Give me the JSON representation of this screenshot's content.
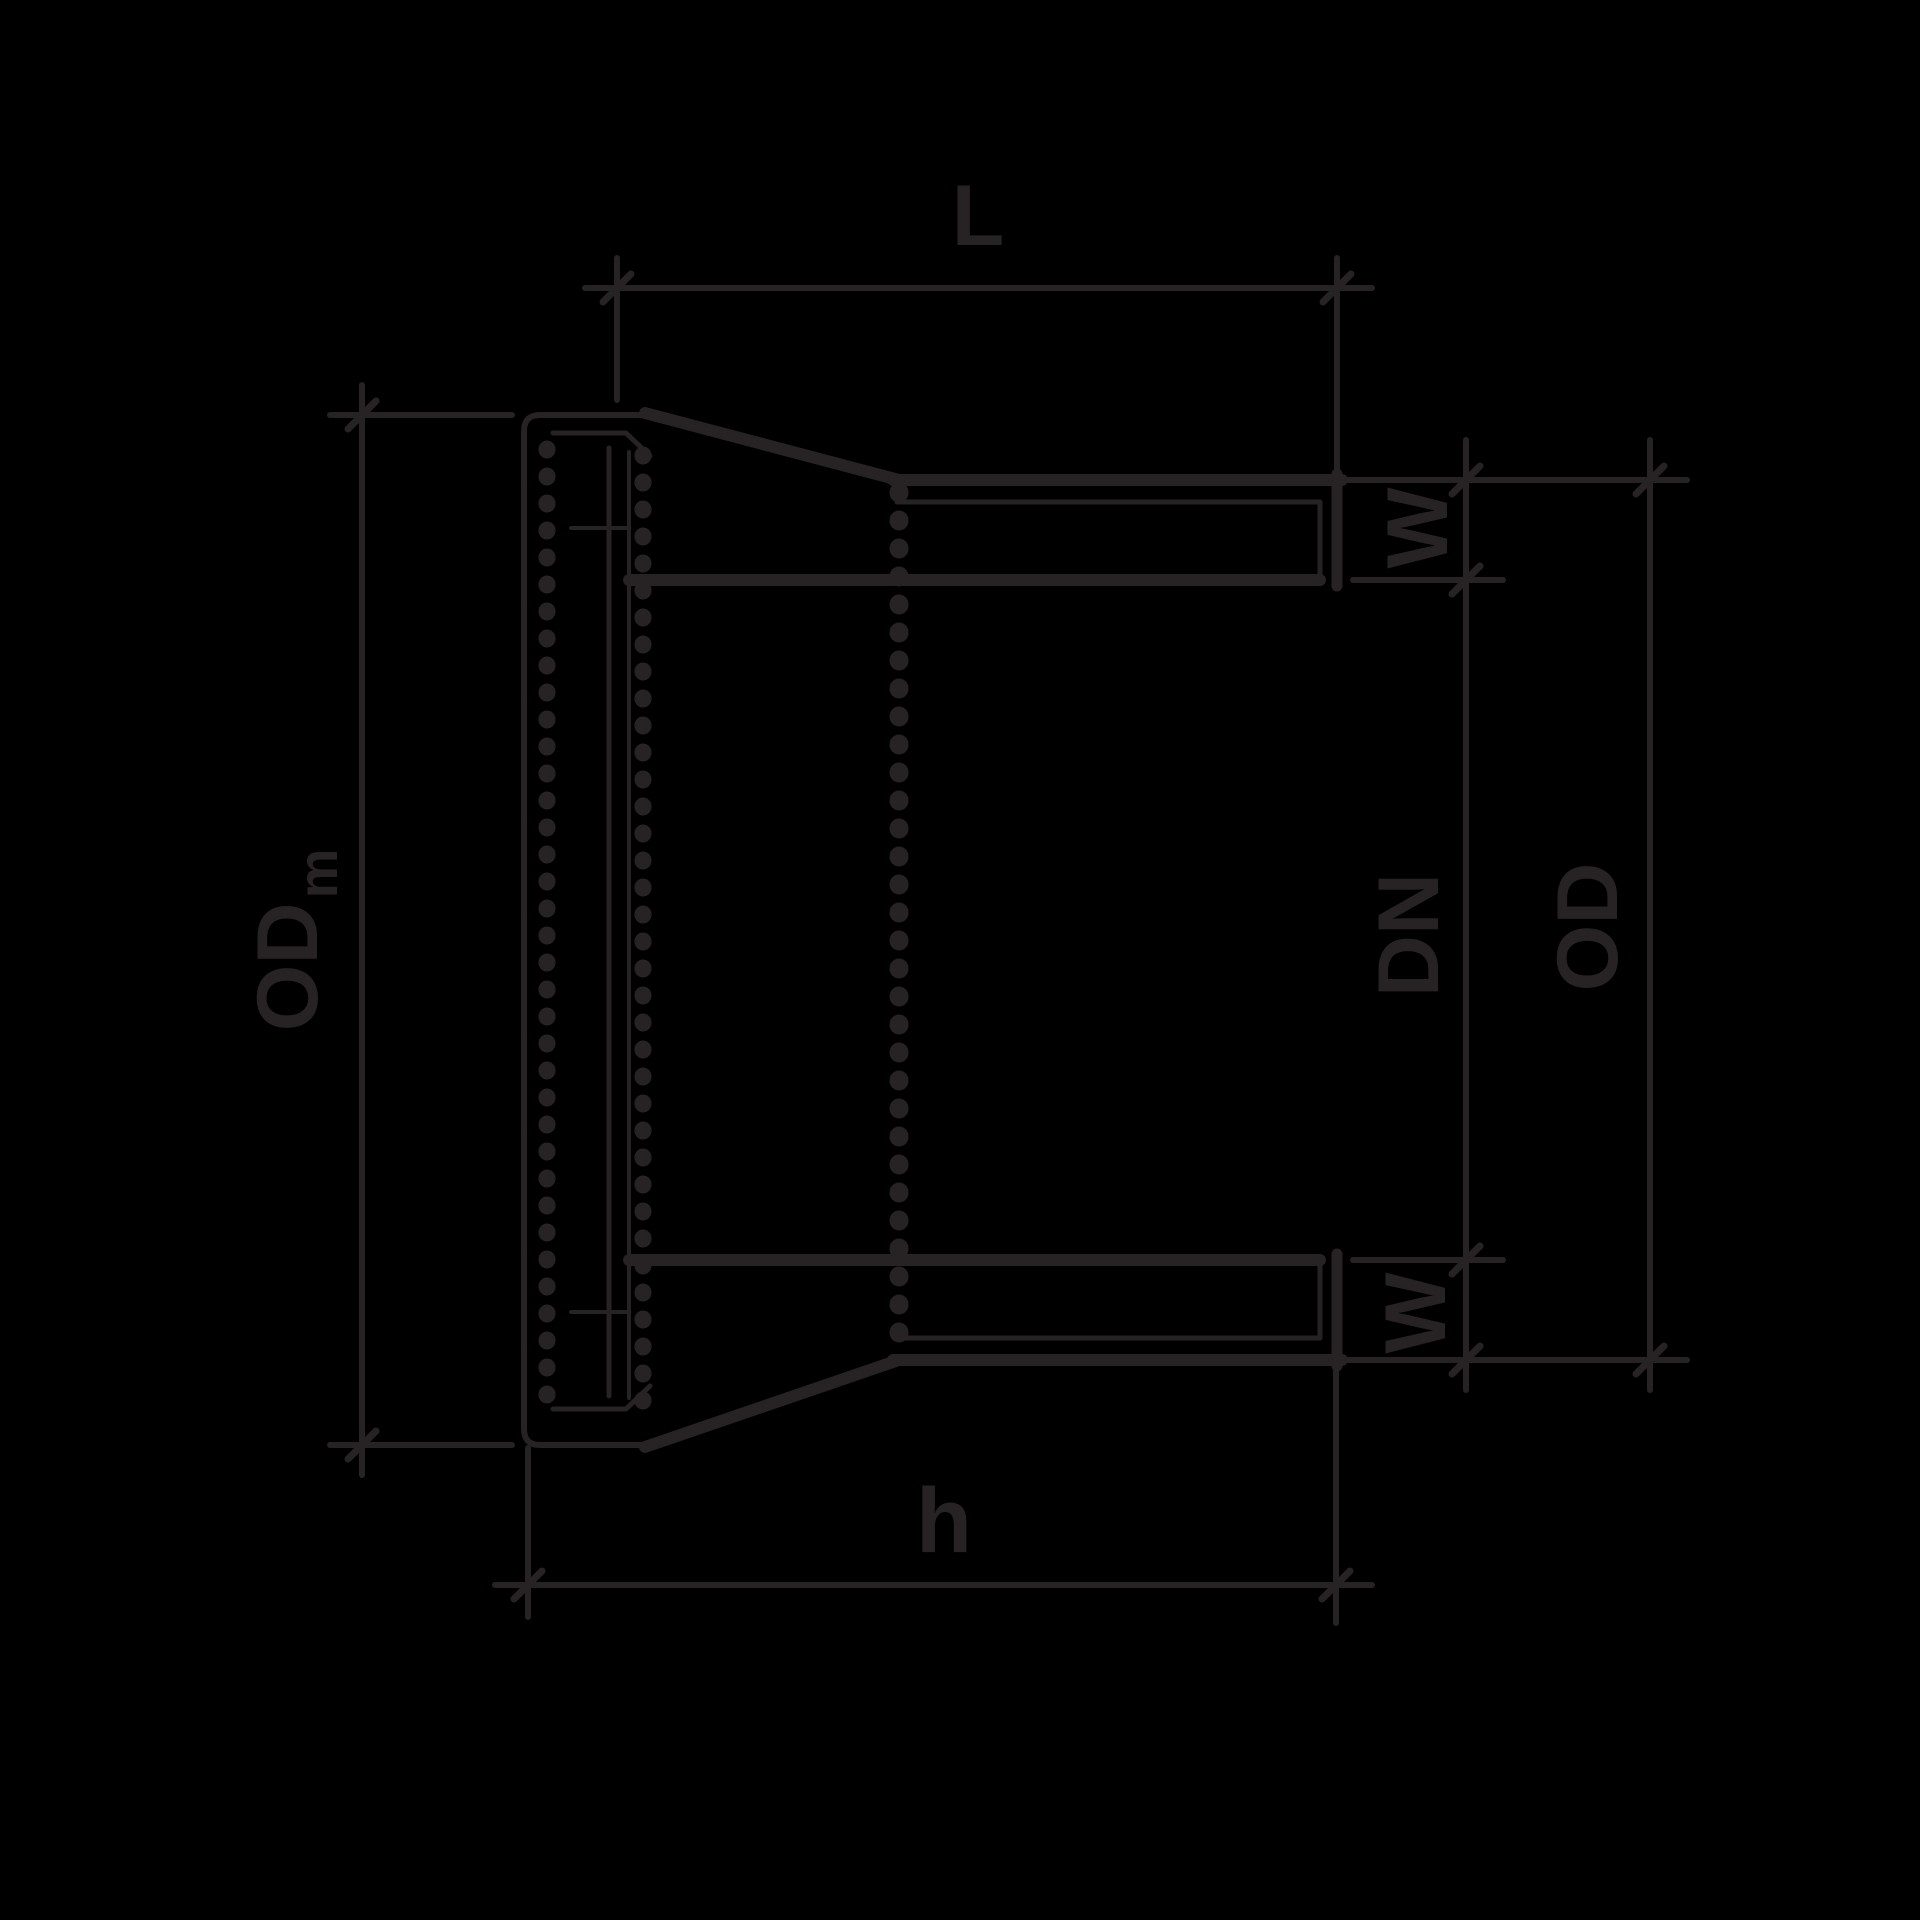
{
  "colors": {
    "background": "#000000",
    "ink": "#272223"
  },
  "labels": {
    "length_top": "L",
    "socket_outer_diameter_main": "OD",
    "socket_outer_diameter_sub": "m",
    "wall_thickness_top": "W",
    "nominal_diameter": "DN",
    "outer_diameter": "OD",
    "wall_thickness_bottom": "W",
    "total_length": "h"
  }
}
